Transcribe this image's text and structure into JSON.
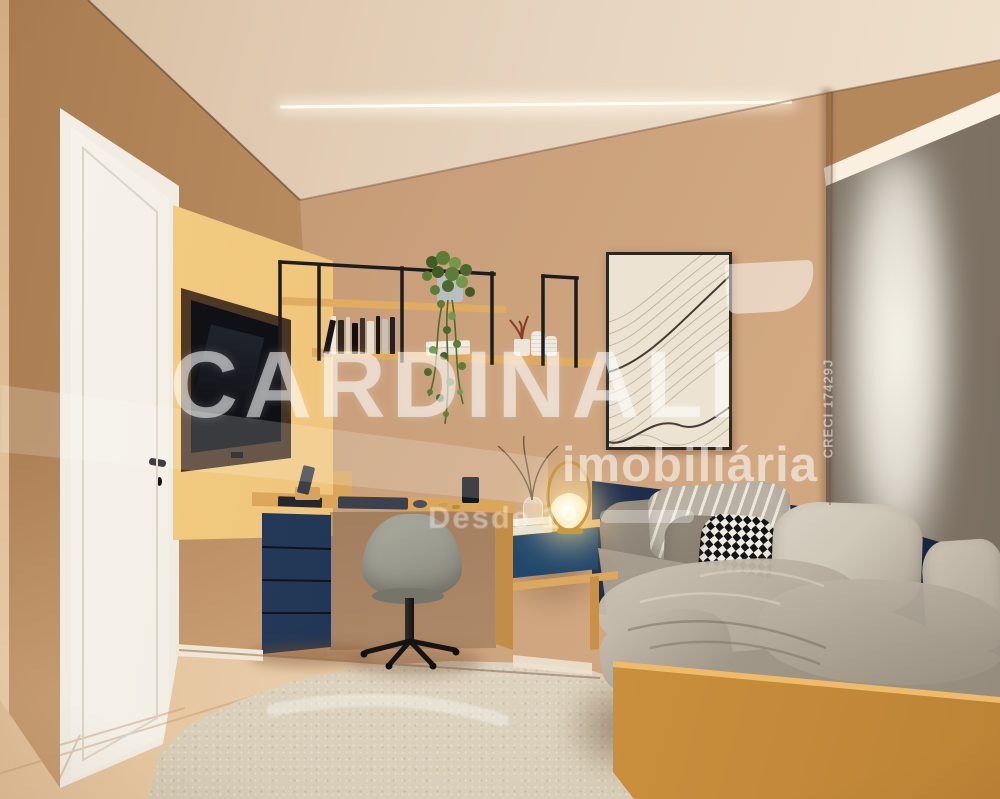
{
  "scene": {
    "description": "3D interior render of a compact bedroom with white door, mustard TV panel, wall shelves, desk with navy drawers, gray swivel chair, abstract line art, roller blind window, navy-and-mustard daybed, floating nightstand with glowing lamp, cream rug"
  },
  "watermark": {
    "brand": "CARDINALI",
    "subtitle": "imobiliária",
    "tagline": "Desde 19",
    "creci": "CRECI 17429J"
  },
  "colors": {
    "wall": "#c9a07b",
    "wallLeft": "#bf9265",
    "ceiling": "#e6d3bd",
    "ceilingBright": "#f2e5d2",
    "yellow": "#eec379",
    "yellowDeep": "#ddab55",
    "door": "#f0ebe1",
    "doorFrame": "#e6dfd1",
    "navy": "#1e3150",
    "navyLight": "#1f466a",
    "mustard": "#d0953f",
    "mustardTop": "#edbb69",
    "linen": "#b2a899",
    "linenDark": "#948a7c",
    "pillowLight": "#cfc7b8",
    "blind": "#8e8376",
    "pelmet": "#f0e5d2",
    "rug": "#d9cfba",
    "floor": "#ecd2af",
    "floorDeep": "#dcb88f",
    "wood": "#dca75e",
    "woodDeep": "#c8914a",
    "screen": "#0b0c10",
    "chair": "#9c9c90",
    "canvas": "#ece3d2",
    "lampGlow": "#f7d089",
    "watermark": "rgba(255,255,255,0.55)"
  }
}
